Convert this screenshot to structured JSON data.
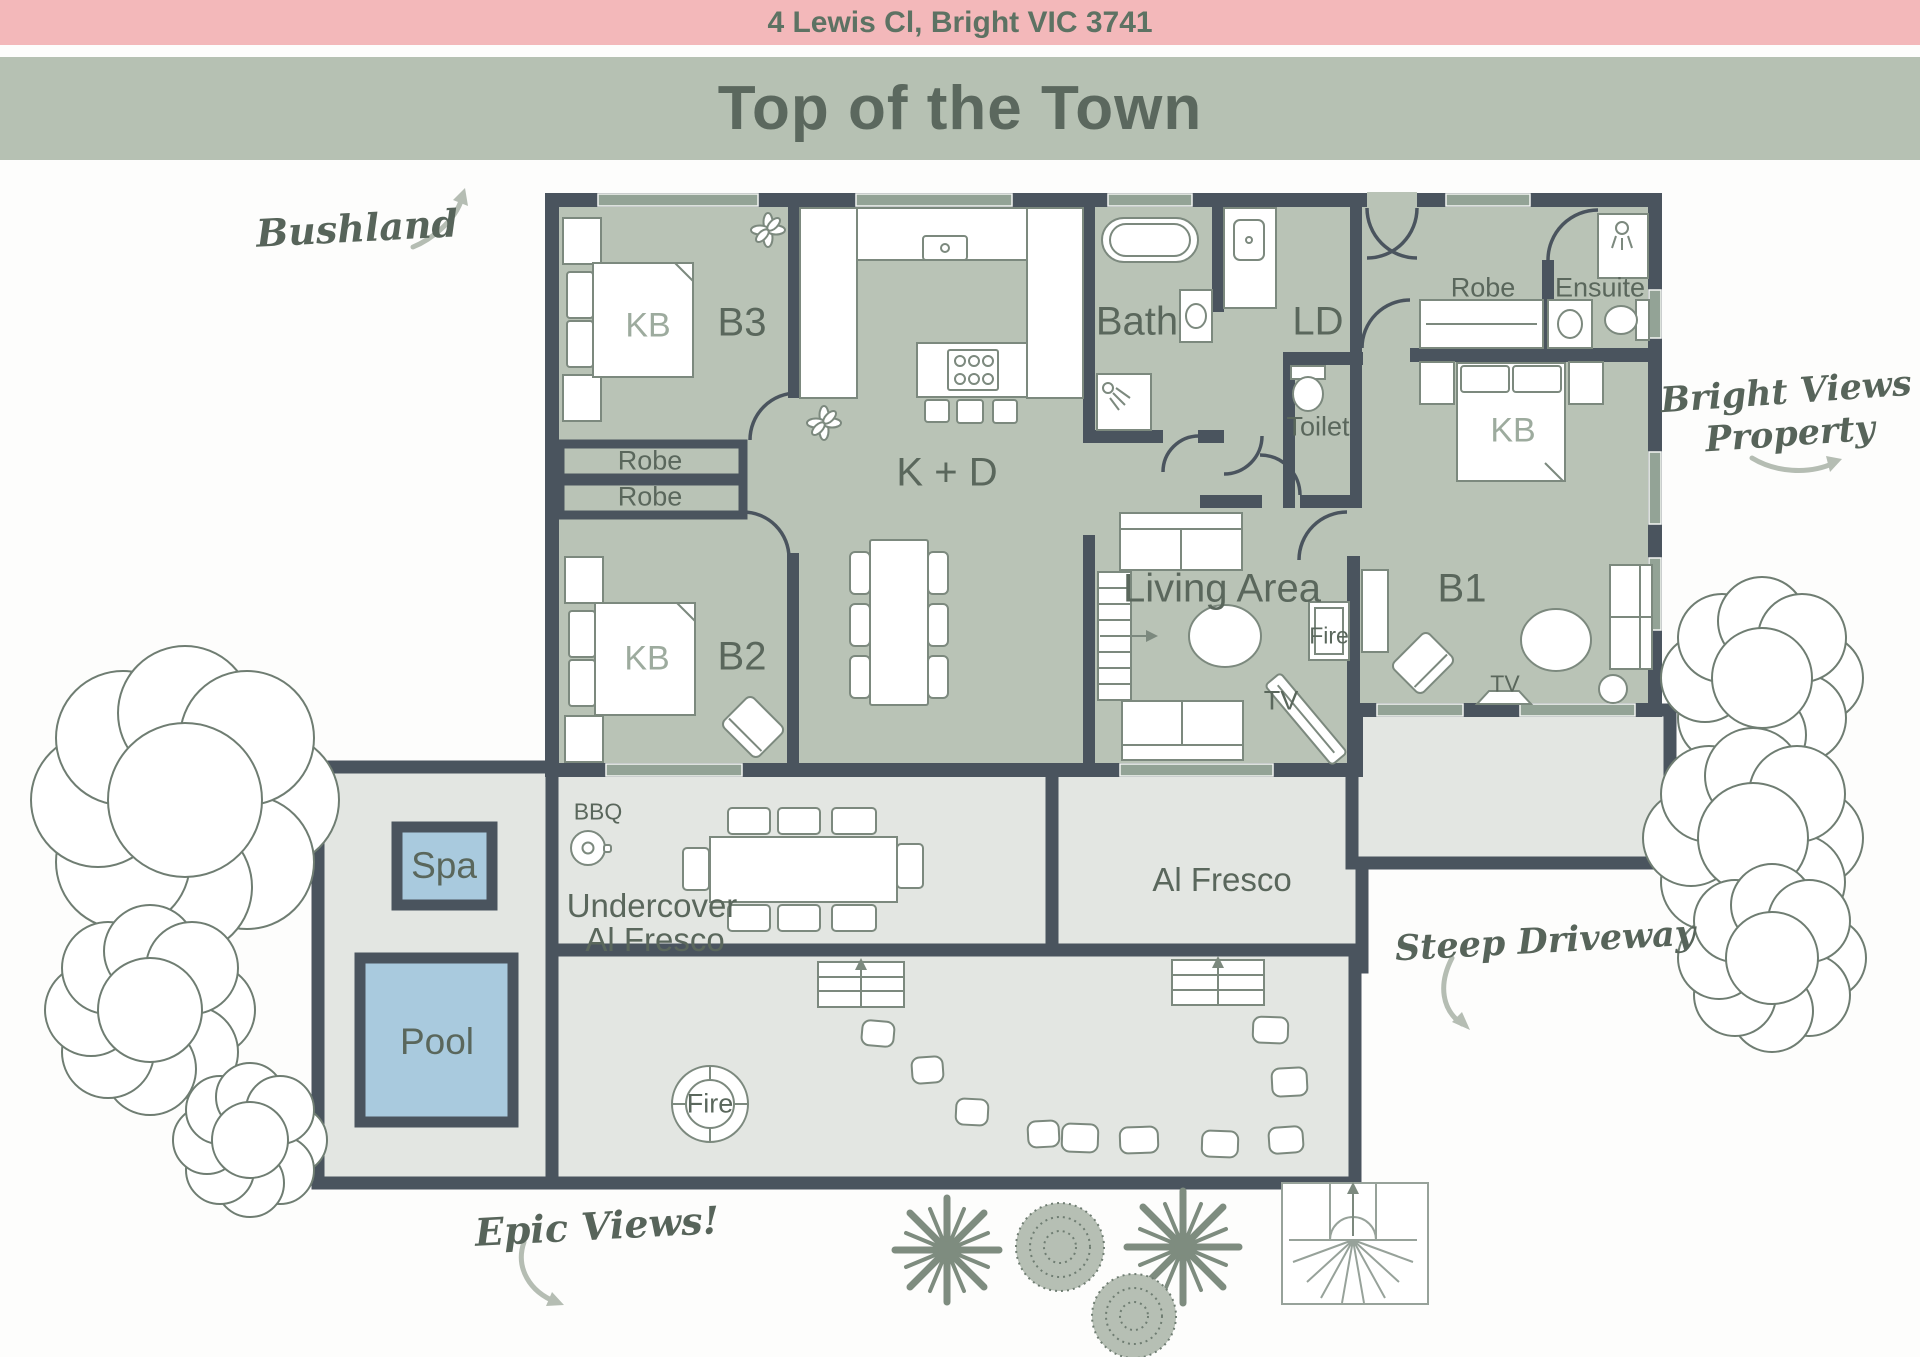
{
  "header": {
    "address": "4 Lewis Cl, Bright VIC 3741",
    "title": "Top of the Town"
  },
  "rooms": {
    "b1": "B1",
    "b2": "B2",
    "b3": "B3",
    "kitchen_dining": "K + D",
    "bath": "Bath",
    "laundry": "LD",
    "toilet": "Toilet",
    "living": "Living Area",
    "ensuite": "Ensuite",
    "robe": "Robe",
    "alfresco": "Al Fresco",
    "undercover_line1": "Undercover",
    "undercover_line2": "Al Fresco",
    "spa": "Spa",
    "pool": "Pool"
  },
  "features": {
    "king_bed": "KB",
    "fire": "Fire",
    "tv": "TV",
    "bbq": "BBQ"
  },
  "annotations": {
    "bushland": "Bushland",
    "bright_views_line1": "Bright Views",
    "bright_views_line2": "Property",
    "steep_driveway": "Steep Driveway",
    "epic_views": "Epic Views!"
  },
  "colors": {
    "header_pink": "#f3b8ba",
    "header_sage": "#b6c1b3",
    "header_text": "#5d7263",
    "title_text": "#5b685e",
    "wall": "#4a545e",
    "room_fill": "#b9c3b6",
    "outdoor_fill": "#e3e6e2",
    "water": "#a9cade",
    "label": "#5a675c",
    "label_light": "#9dab9e",
    "furniture_stroke": "#7c897e",
    "annotation": "#57645a",
    "arrow": "#b5bdb3",
    "tree": "#6f7d72",
    "window": "#93a396"
  }
}
